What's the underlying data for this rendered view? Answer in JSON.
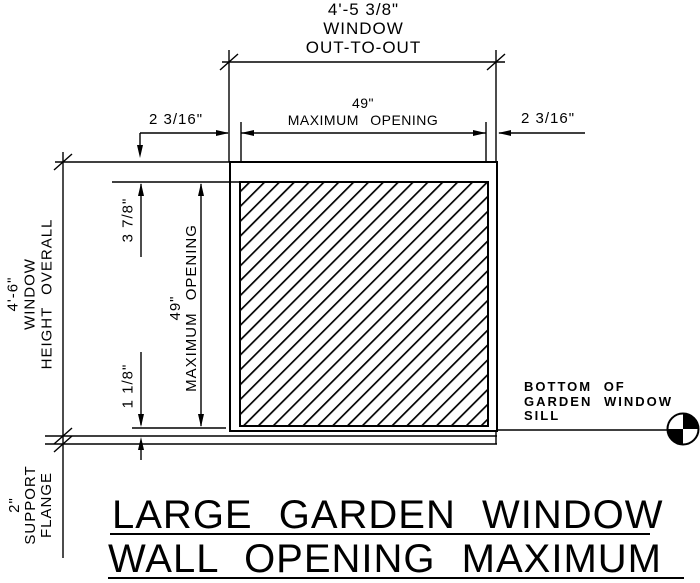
{
  "title": {
    "line1": "LARGE GARDEN WINDOW",
    "line2": "WALL OPENING MAXIMUM"
  },
  "dimensions": {
    "out_to_out": {
      "value": "4'-5 3/8\"",
      "line2": "WINDOW",
      "line3": "OUT-TO-OUT"
    },
    "opening_width": {
      "value": "49\"",
      "label": "MAXIMUM OPENING"
    },
    "jamb_left": {
      "value": "2 3/16\""
    },
    "jamb_right": {
      "value": "2 3/16\""
    },
    "height_overall": {
      "value": "4'-6\"",
      "line2": "WINDOW",
      "line3": "HEIGHT OVERALL"
    },
    "head_gap": {
      "value": "3 7/8\""
    },
    "opening_height": {
      "value": "49\"",
      "label": "MAXIMUM OPENING"
    },
    "sill_gap": {
      "value": "1 1/8\""
    },
    "support_flange": {
      "value": "2\"",
      "line2": "SUPPORT",
      "line3": "FLANGE"
    }
  },
  "callout_sill": {
    "line1": "BOTTOM OF",
    "line2": "GARDEN WINDOW",
    "line3": "SILL"
  },
  "colors": {
    "ink": "#000000",
    "paper": "#ffffff"
  }
}
